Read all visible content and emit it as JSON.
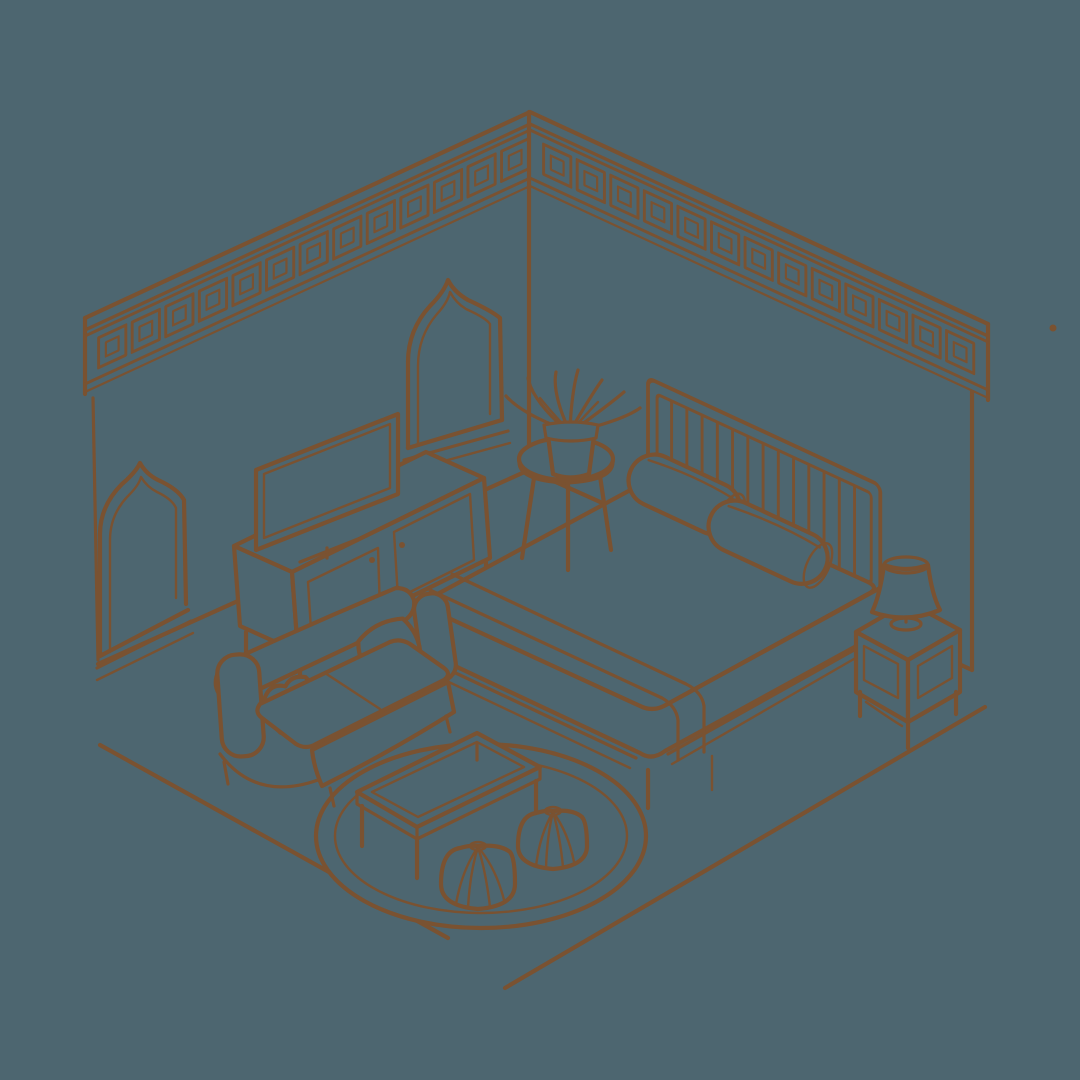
{
  "scene": {
    "title": "Hand-drawn isometric bedroom illustration",
    "description": "Single-colour sepia line sketch of a bedroom interior drawn in isometric view on a slate background",
    "background_color": "#4d6670",
    "ink_color": "#7a5231",
    "ink_color_soft": "#75512d"
  },
  "room": {
    "left_wall": {
      "frieze_pattern": "greek-key",
      "frieze_tiles": 13,
      "window_count": 2
    },
    "right_wall": {
      "frieze_pattern": "greek-key",
      "frieze_tiles": 13,
      "window_count": 0
    },
    "windows": [
      {
        "label": "arched window far left",
        "arch": "ogee"
      },
      {
        "label": "arched window near corner",
        "arch": "ogee"
      }
    ]
  },
  "objects": {
    "bed": {
      "label": "double bed",
      "headboard_slats": 13,
      "bolster_pillows": 2,
      "has_blanket": true
    },
    "nightstand": {
      "label": "nightstand",
      "drawers": 1
    },
    "table_lamp": {
      "label": "table lamp",
      "parts": [
        "shade",
        "stem",
        "base"
      ]
    },
    "side_table": {
      "label": "round side table",
      "legs": 3
    },
    "plant": {
      "label": "potted plant",
      "leaves": 8
    },
    "tv": {
      "label": "television"
    },
    "media_console": {
      "label": "media console",
      "doors": 2,
      "handles": 2
    },
    "sofa": {
      "label": "loveseat sofa",
      "seat_cushions": 2,
      "throw_pillows": 2
    },
    "coffee_table": {
      "label": "coffee table",
      "legs": 4
    },
    "rug": {
      "label": "round rug",
      "pattern": "herringbone"
    },
    "poufs": {
      "label": "moroccan segmented poufs",
      "count": 2
    }
  }
}
